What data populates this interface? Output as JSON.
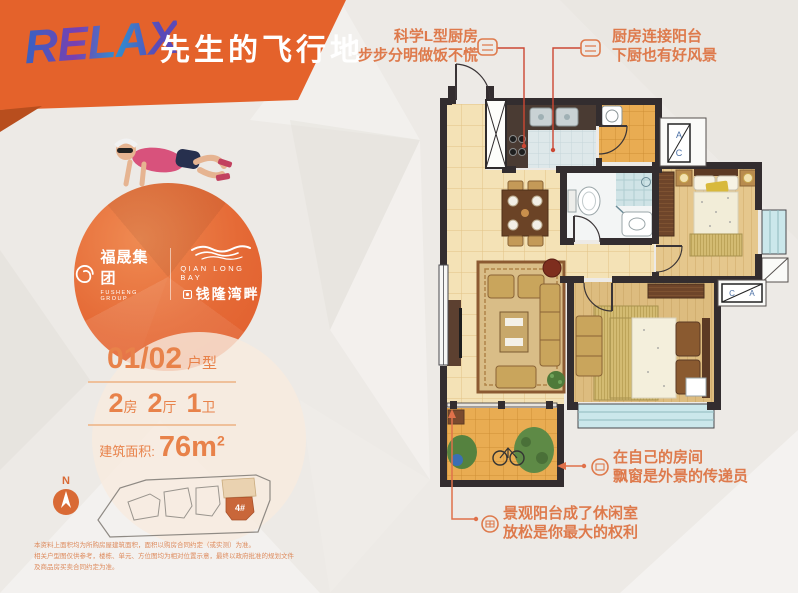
{
  "banner": {
    "relax": "RELAX",
    "title": "先生的飞行地"
  },
  "brand": {
    "group_name": "福晟集团",
    "group_sub": "FUSHENG GROUP",
    "project_en": "QIAN LONG BAY",
    "project_cn": "钱隆湾畔"
  },
  "specs": {
    "unit_no": "01/02",
    "unit_label": "户型",
    "layout": [
      {
        "num": "2",
        "label": "房"
      },
      {
        "num": "2",
        "label": "厅"
      },
      {
        "num": "1",
        "label": "卫"
      }
    ],
    "area_label": "建筑面积:",
    "area_value": "76m",
    "area_exponent": "2"
  },
  "callouts": {
    "kitchen": {
      "line1": "科学L型厨房",
      "line2": "步步分明做饭不慌"
    },
    "kitchen_balcony": {
      "line1": "厨房连接阳台",
      "line2": "下厨也有好风景"
    },
    "bedroom": {
      "line1": "在自己的房间",
      "line2": "飘窗是外景的传递员"
    },
    "balcony": {
      "line1": "景观阳台成了休闲室",
      "line2": "放松是你最大的权利"
    }
  },
  "floorplan": {
    "ac_letter_a": "A",
    "ac_letter_c": "C"
  },
  "siteplan": {
    "compass": "N",
    "building_label": "4#"
  },
  "disclaimer": {
    "line1": "本资料上面积均为所购房屋建筑面积，面积以购房合同约定（或实测）为准。",
    "line2": "相关户型图仅供参考，楼栋、单元、方位图均为相对位置示意，最终以政府批准的规划文件及商品房买卖合同约定为准。"
  },
  "colors": {
    "accent": "#E4622B",
    "callout_text": "#DE7A4C",
    "spec_text": "#E8824A",
    "wall": "#332D2F",
    "red_line": "#CC4733"
  }
}
